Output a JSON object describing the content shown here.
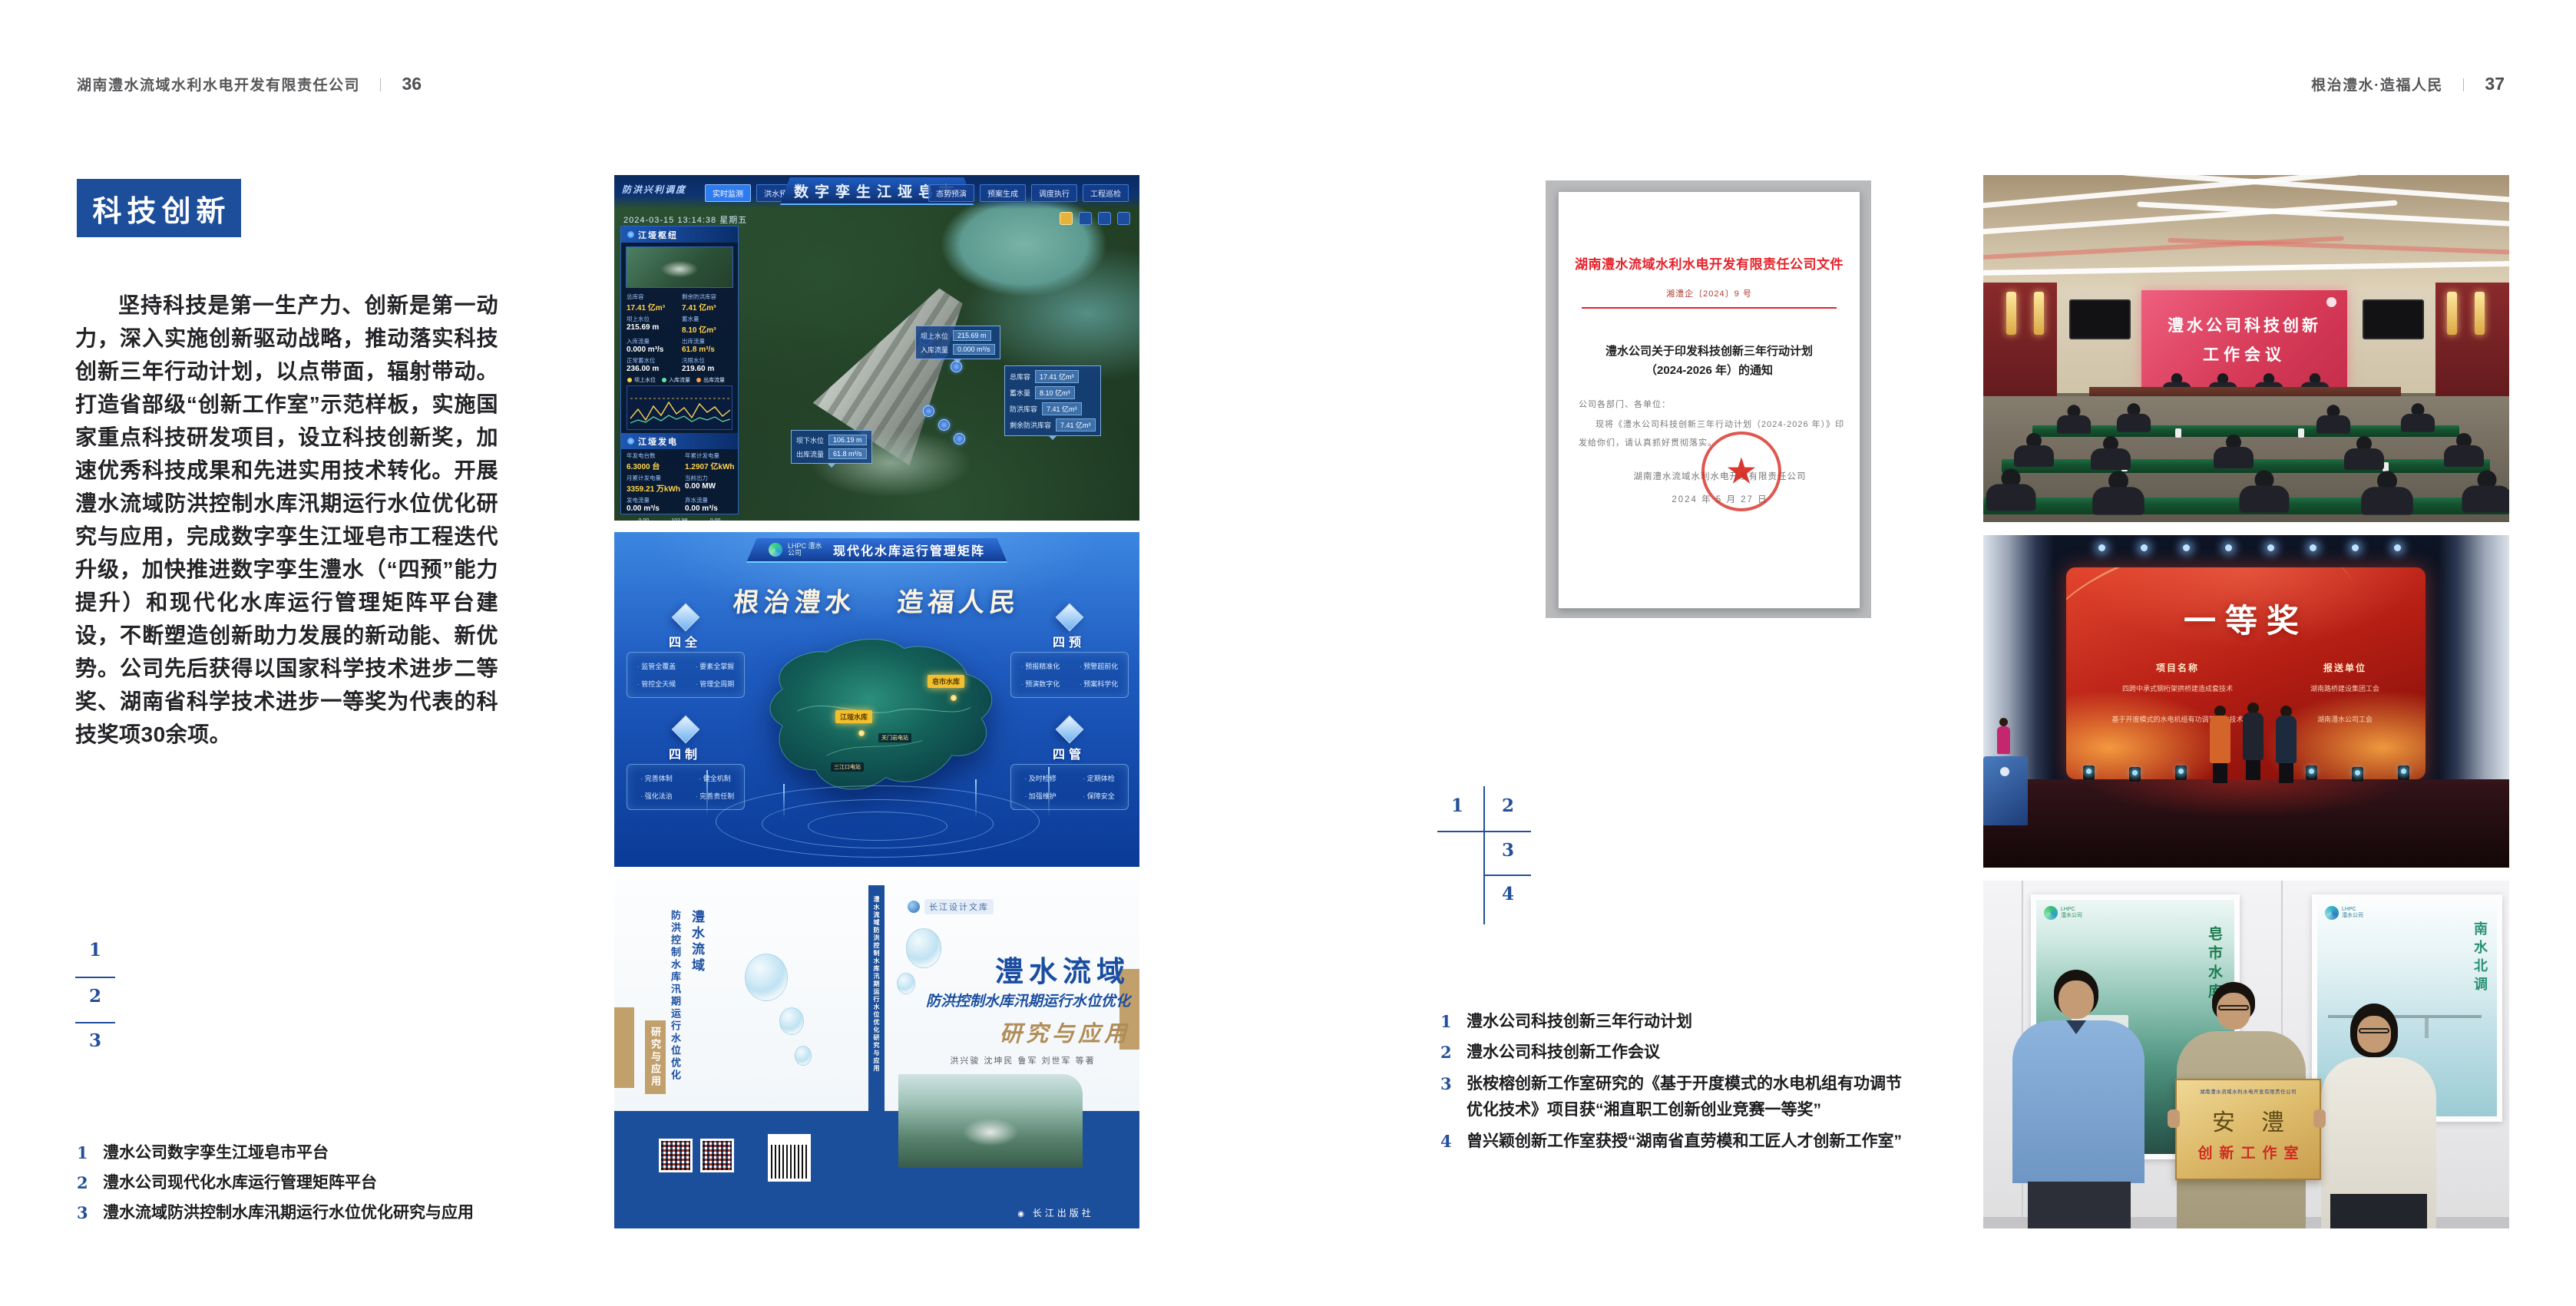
{
  "colors": {
    "accent_blue": "#1d4e9b",
    "index_blue": "#234f9a",
    "doc_red": "#e62129",
    "book_gold": "#b08d57"
  },
  "left_page": {
    "header": {
      "company": "湖南澧水流域水利水电开发有限责任公司",
      "divider": "｜",
      "page_no": "36"
    },
    "section_title": "科技创新",
    "paragraph": "坚持科技是第一生产力、创新是第一动力，深入实施创新驱动战略，推动落实科技创新三年行动计划，以点带面，辐射带动。打造省部级“创新工作室”示范样板，实施国家重点科技研发项目，设立科技创新奖，加速优秀科技成果和先进实用技术转化。开展澧水流域防洪控制水库汛期运行水位优化研究与应用，完成数字孪生江垭皂市工程迭代升级，加快推进数字孪生澧水（“四预”能力提升）和现代化水库运行管理矩阵平台建设，不断塑造创新助力发展的新动能、新优势。公司先后获得以国家科学技术进步二等奖、湖南省科学技术进步一等奖为代表的科技奖项30余项。",
    "figure_index": [
      "1",
      "2",
      "3"
    ],
    "captions": [
      {
        "n": "1",
        "t": "澧水公司数字孪生江垭皂市平台"
      },
      {
        "n": "2",
        "t": "澧水公司现代化水库运行管理矩阵平台"
      },
      {
        "n": "3",
        "t": "澧水流域防洪控制水库汛期运行水位优化研究与应用"
      }
    ]
  },
  "right_page": {
    "header": {
      "motto": "根治澧水·造福人民",
      "divider": "｜",
      "page_no": "37"
    },
    "figure_index": [
      "1",
      "2",
      "3",
      "4"
    ],
    "captions": [
      {
        "n": "1",
        "t": "澧水公司科技创新三年行动计划"
      },
      {
        "n": "2",
        "t": "澧水公司科技创新工作会议"
      },
      {
        "n": "3",
        "t": "张桉榕创新工作室研究的《基于开度模式的水电机组有功调节优化技术》项目获“湘直职工创新创业竞赛一等奖”"
      },
      {
        "n": "4",
        "t": "曾兴颖创新工作室获授“湖南省直劳模和工匠人才创新工作室”"
      }
    ]
  },
  "fig_dashboard": {
    "title": "数字孪生江垭皂市",
    "corner_label": "防洪兴利调度",
    "datetime": "2024-03-15 13:14:38 星期五",
    "tabs_left": [
      "实时监测",
      "洪水预报",
      "防洪预警"
    ],
    "tabs_right": [
      "态势预演",
      "预案生成",
      "调度执行",
      "工程巡检"
    ],
    "panel_hub": {
      "title": "江垭枢纽",
      "stats": [
        {
          "l": "总库容",
          "v": "17.41 亿m³"
        },
        {
          "l": "剩余防洪库容",
          "v": "7.41 亿m³"
        },
        {
          "l": "坝上水位",
          "v": "215.69 m"
        },
        {
          "l": "蓄水量",
          "v": "8.10 亿m³"
        },
        {
          "l": "入库流量",
          "v": "0.000 m³/s"
        },
        {
          "l": "出库流量",
          "v": "61.8 m³/s"
        },
        {
          "l": "正常蓄水位",
          "v": "236.00 m"
        },
        {
          "l": "汛限水位",
          "v": "219.60 m"
        }
      ]
    },
    "chart_legend": [
      "坝上水位",
      "入库流量",
      "出库流量"
    ],
    "panel_power": {
      "title": "江垭发电",
      "stats": [
        {
          "l": "年发电台数",
          "v": "6.3000 台"
        },
        {
          "l": "年累计发电量",
          "v": "1.2907 亿kWh"
        },
        {
          "l": "月累计发电量",
          "v": "3359.21 万kWh"
        },
        {
          "l": "当前出力",
          "v": "0.00 MW"
        },
        {
          "l": "发电流量",
          "v": "0.00 m³/s"
        },
        {
          "l": "弃水流量",
          "v": "0.00 m³/s"
        }
      ],
      "gauges": [
        "0.00",
        "102.98",
        "0.00"
      ]
    },
    "tip_upstream": [
      {
        "l": "坝上水位",
        "v": "215.69 m"
      },
      {
        "l": "入库流量",
        "v": "0.000 m³/s"
      }
    ],
    "tip_capacity": [
      {
        "l": "总库容",
        "v": "17.41 亿m³"
      },
      {
        "l": "蓄水量",
        "v": "8.10 亿m³"
      },
      {
        "l": "防洪库容",
        "v": "7.41 亿m³"
      },
      {
        "l": "剩余防洪库容",
        "v": "7.41 亿m³"
      }
    ],
    "tip_downstream": [
      {
        "l": "坝下水位",
        "v": "106.19 m"
      },
      {
        "l": "出库流量",
        "v": "61.8 m³/s"
      }
    ]
  },
  "fig_matrix": {
    "brand": "LHPC 澧水公司",
    "title": "现代化水库运行管理矩阵",
    "slogan_a": "根治澧水",
    "slogan_b": "造福人民",
    "groups": [
      {
        "name": "四全",
        "items": [
          "监管全覆盖",
          "要素全掌握",
          "管控全天候",
          "管理全周期"
        ]
      },
      {
        "name": "四预",
        "items": [
          "预报精准化",
          "预警超前化",
          "预演数字化",
          "预案科学化"
        ]
      },
      {
        "name": "四制",
        "items": [
          "完善体制",
          "健全机制",
          "强化法治",
          "完善责任制"
        ]
      },
      {
        "name": "四管",
        "items": [
          "及时检修",
          "定期体检",
          "加强维护",
          "保障安全"
        ]
      }
    ],
    "pins_major": [
      "皂市水库",
      "江垭水库"
    ],
    "pins_minor": [
      "关门岩电站",
      "三江口电站"
    ]
  },
  "fig_book": {
    "library": "长江设计文库",
    "title_region": "澧水流域",
    "title_sub": "防洪控制水库汛期运行水位优化",
    "title_tail": "研究与应用",
    "authors": "洪兴骏 沈坤民 鲁军 刘世军 等著",
    "publisher": "长江出版社",
    "spine_title": "澧水流域防洪控制水库汛期运行水位优化研究与应用"
  },
  "photo_doc": {
    "header": "湖南澧水流域水利水电开发有限责任公司文件",
    "doc_no": "湘澧企〔2024〕9 号",
    "title_line1": "澧水公司关于印发科技创新三年行动计划",
    "title_line2": "（2024-2026 年）的通知",
    "salutation": "公司各部门、各单位：",
    "body_line1": "现将《澧水公司科技创新三年行动计划（2024-2026 年）》印",
    "body_line2": "发给你们，请认真抓好贯彻落实。",
    "signer": "湖南澧水流域水利水电开发有限责任公司",
    "date": "2024 年 5 月 27 日",
    "seal_star": "★"
  },
  "photo_meeting": {
    "screen_line1": "澧水公司科技创新",
    "screen_line2": "工作会议"
  },
  "photo_award": {
    "title": "一等奖",
    "col_project": "项目名称",
    "col_unit": "报送单位",
    "rows": [
      {
        "p": "四跨中承式钢桁架拱桥建造成套技术",
        "u": "湖南路桥建设集团工会"
      },
      {
        "p": "基于开度模式的水电机组有功调节优化技术",
        "u": "湖南澧水公司工会"
      }
    ]
  },
  "photo_plaque": {
    "poster1_text": "皂市水库",
    "poster2_text": "南水北调",
    "plaque_company": "湖南澧水流域水利水电开发有限责任公司",
    "plaque_main": "安澧",
    "plaque_sub": "创新工作室"
  }
}
